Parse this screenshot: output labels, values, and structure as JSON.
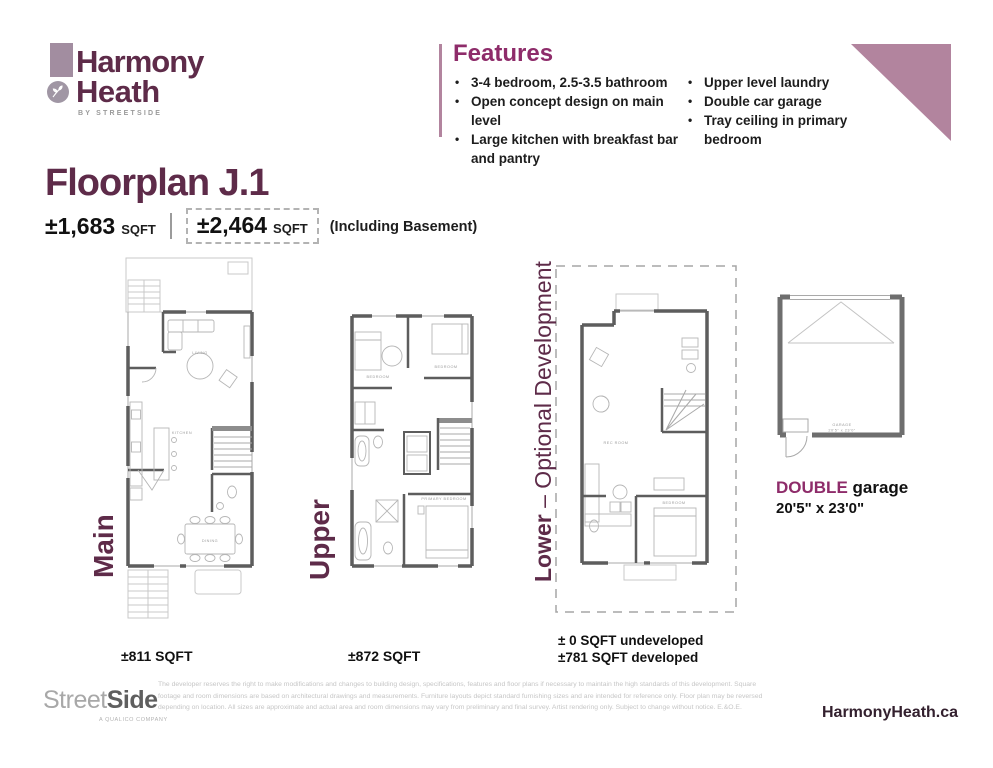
{
  "brand": {
    "logo_line1": "Harmony",
    "logo_line2": "Heath",
    "tagline": "BY STREETSIDE"
  },
  "features": {
    "title": "Features",
    "col1": [
      "3-4 bedroom, 2.5-3.5 bathroom",
      "Open concept design on main level",
      "Large kitchen with breakfast bar and pantry"
    ],
    "col2": [
      "Upper level laundry",
      "Double car garage",
      "Tray ceiling in primary bedroom"
    ],
    "bullet": "•"
  },
  "floorplan": {
    "title": "Floorplan J.1",
    "sqft_main": "±1,683",
    "sqft_main_unit": "SQFT",
    "sqft_total": "±2,464",
    "sqft_total_unit": "SQFT",
    "note": "(Including Basement)"
  },
  "plans": {
    "main": {
      "label": "Main",
      "caption": "±811 SQFT",
      "rooms": {
        "living": "LIVING",
        "kitchen": "KITCHEN",
        "dining": "DINING"
      }
    },
    "upper": {
      "label": "Upper",
      "caption": "±872 SQFT",
      "rooms": {
        "bed1": "BEDROOM",
        "bed2": "BEDROOM",
        "primary": "PRIMARY BEDROOM"
      }
    },
    "lower": {
      "label_bold": "Lower",
      "label_rest": " – Optional Development",
      "caption_line1": "± 0 SQFT undeveloped",
      "caption_line2": "±781 SQFT developed",
      "rooms": {
        "rec": "REC ROOM",
        "bed": "BEDROOM"
      }
    },
    "garage": {
      "label_bold": "DOUBLE",
      "label_rest": " garage",
      "dimensions": "20'5\" x 23'0\"",
      "inner_line1": "GARAGE",
      "inner_line2": "20'5\" x 23'0\""
    }
  },
  "footer": {
    "logo_light": "Street",
    "logo_bold": "Side",
    "logo_sub": "A QUALICO COMPANY",
    "disclaimer_line1": "The developer reserves the right to make modifications and changes to building design, specifications, features and floor plans if necessary to maintain the high standards of this development. Square",
    "disclaimer_line2": "footage and room dimensions are based on architectural drawings and measurements. Furniture layouts depict standard furnishing sizes and are intended for reference only. Floor plan may be reversed",
    "disclaimer_line3": "depending on location. All sizes are approximate and actual area and room dimensions may vary from preliminary and final survey. Artist rendering only. Subject to change without notice. E.&O.E.",
    "website": "HarmonyHeath.ca"
  },
  "colors": {
    "brand_purple": "#5e2b49",
    "accent_magenta": "#8e2c6a",
    "mauve": "#b2849e",
    "wall_gray": "#5d5d5d"
  }
}
